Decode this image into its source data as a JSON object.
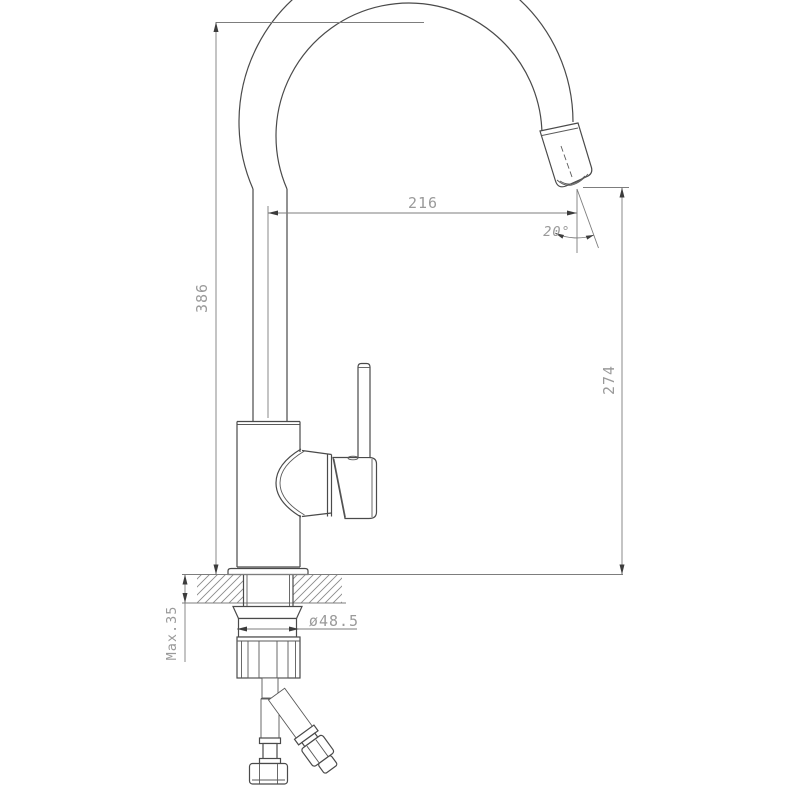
{
  "drawing": {
    "type": "technical-dimension-drawing",
    "subject": "kitchen faucet side view with mounting hardware",
    "labels": {
      "overall_height": "386",
      "spout_reach": "216",
      "spout_angle": "20°",
      "outlet_height": "274",
      "max_counter_thickness": "Max.35",
      "mounting_diameter": "ø48.5"
    },
    "colors": {
      "background": "#ffffff",
      "outline": "#4a4a4a",
      "dimension_line": "#7d7d7d",
      "dimension_text": "#9a9a9a",
      "arrowhead": "#3c3c3c"
    }
  }
}
